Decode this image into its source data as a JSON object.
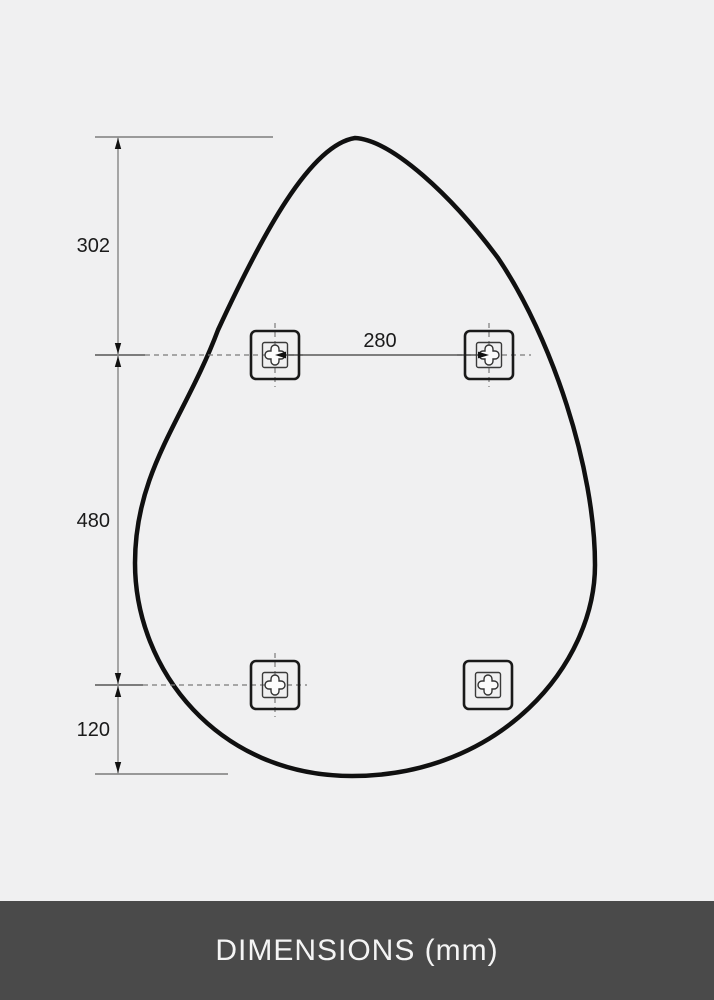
{
  "page": {
    "background_color": "#f0f0f1"
  },
  "banner": {
    "label": "DIMENSIONS (mm)",
    "background_color": "#4a4a4a",
    "text_color": "#f4f4f4"
  },
  "diagram": {
    "type": "product-dimension-drawing",
    "shape": "teardrop-mirror-outline",
    "mounting_brackets_count": 4,
    "labels": {
      "top_edge_to_holes": "302",
      "holes_horizontal_spacing": "280",
      "holes_vertical_spacing": "480",
      "holes_to_bottom_edge": "120"
    },
    "colors": {
      "mirror_outline": "#101010",
      "dimension_line": "#8c8c8c",
      "tick_line": "#555555",
      "dashed_line": "#7a7a7a",
      "reference_line": "#9a9a9a",
      "arrow": "#111111",
      "label_text": "#1a1a1a",
      "bracket_frame": "#1a1a1a",
      "bracket_plate": "#3a3a3a",
      "bracket_cross_fill": "#fbfbfb"
    }
  }
}
